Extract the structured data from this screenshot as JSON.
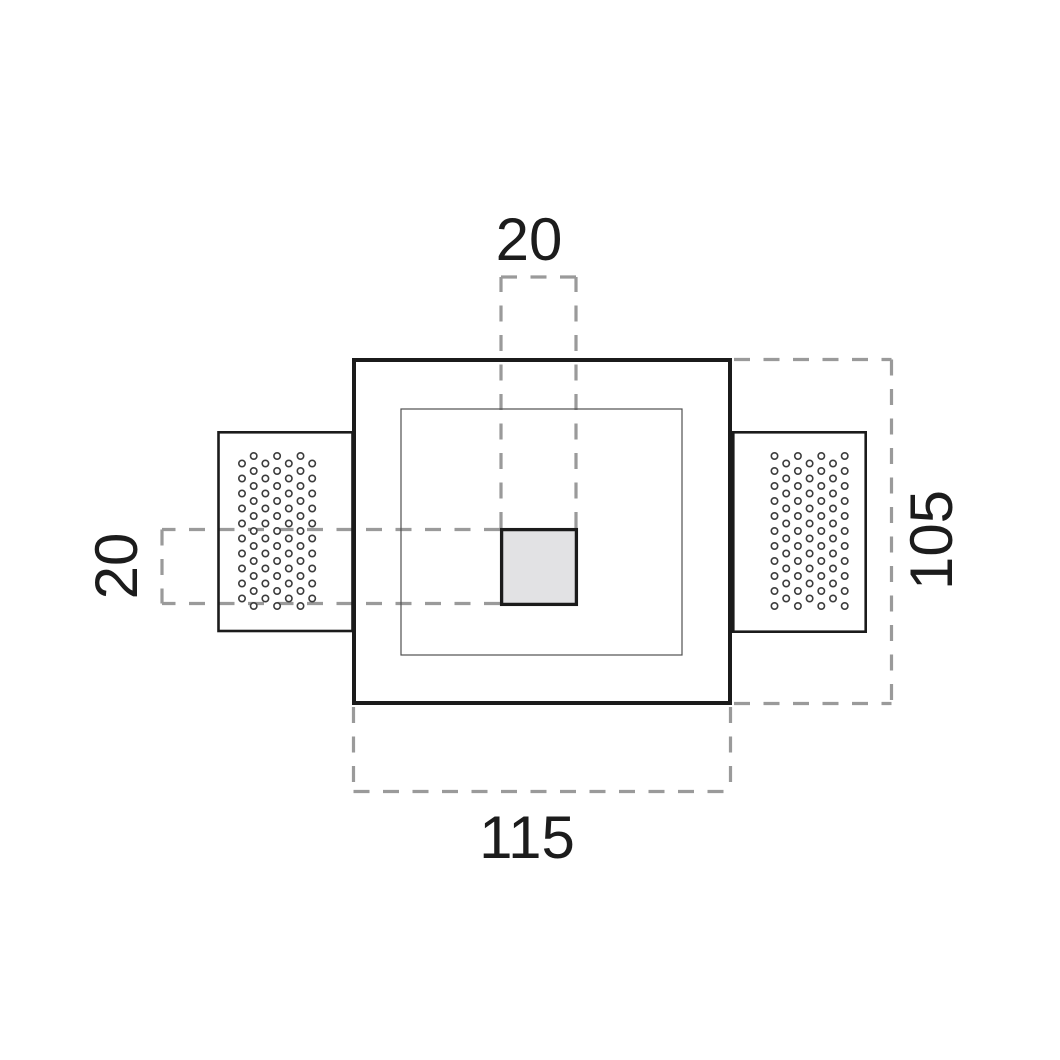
{
  "dimensions": {
    "center_square_width": "20",
    "center_square_height": "20",
    "body_height": "105",
    "body_width": "115"
  },
  "colors": {
    "background": "#ffffff",
    "line": "#1b1b1b",
    "thin_line": "#4f4f4f",
    "dashed_line": "#9a9a9a",
    "center_square_fill": "#e2e2e4",
    "perforation_ring": "#3c3c3c",
    "label_text": "#1c1c1c"
  }
}
